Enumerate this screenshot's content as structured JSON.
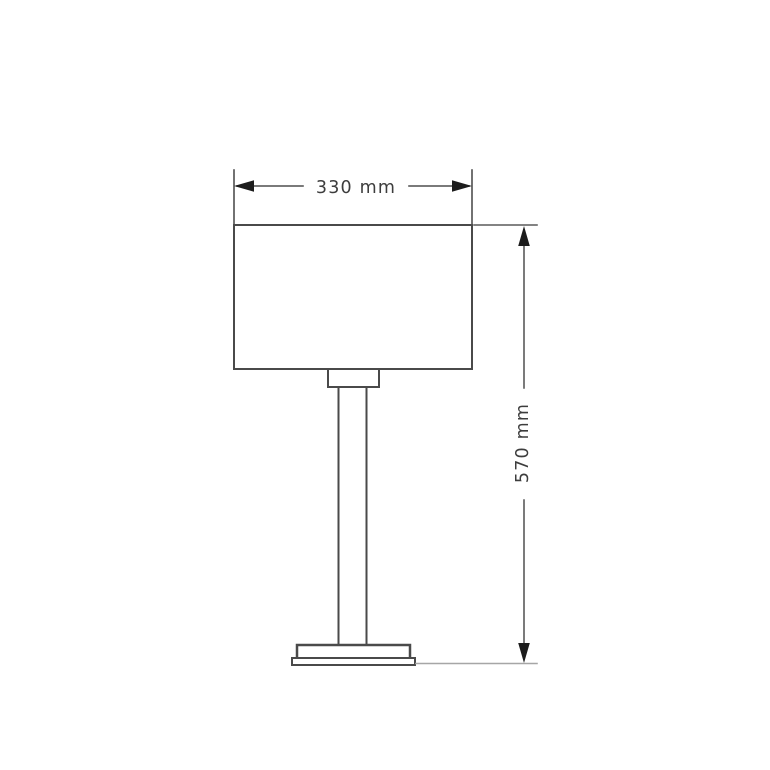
{
  "drawing": {
    "dimensions": {
      "width": {
        "label": "330 mm"
      },
      "height": {
        "label": "570 mm"
      }
    },
    "colors": {
      "outline": "#4a4a4a",
      "dimension_line": "#4f4f4f",
      "extension_line": "#5a5a5a",
      "ground_line": "#a6a6a6",
      "arrow": "#1c1c1c",
      "label_text": "#3d3d3d",
      "background": "#ffffff"
    }
  }
}
